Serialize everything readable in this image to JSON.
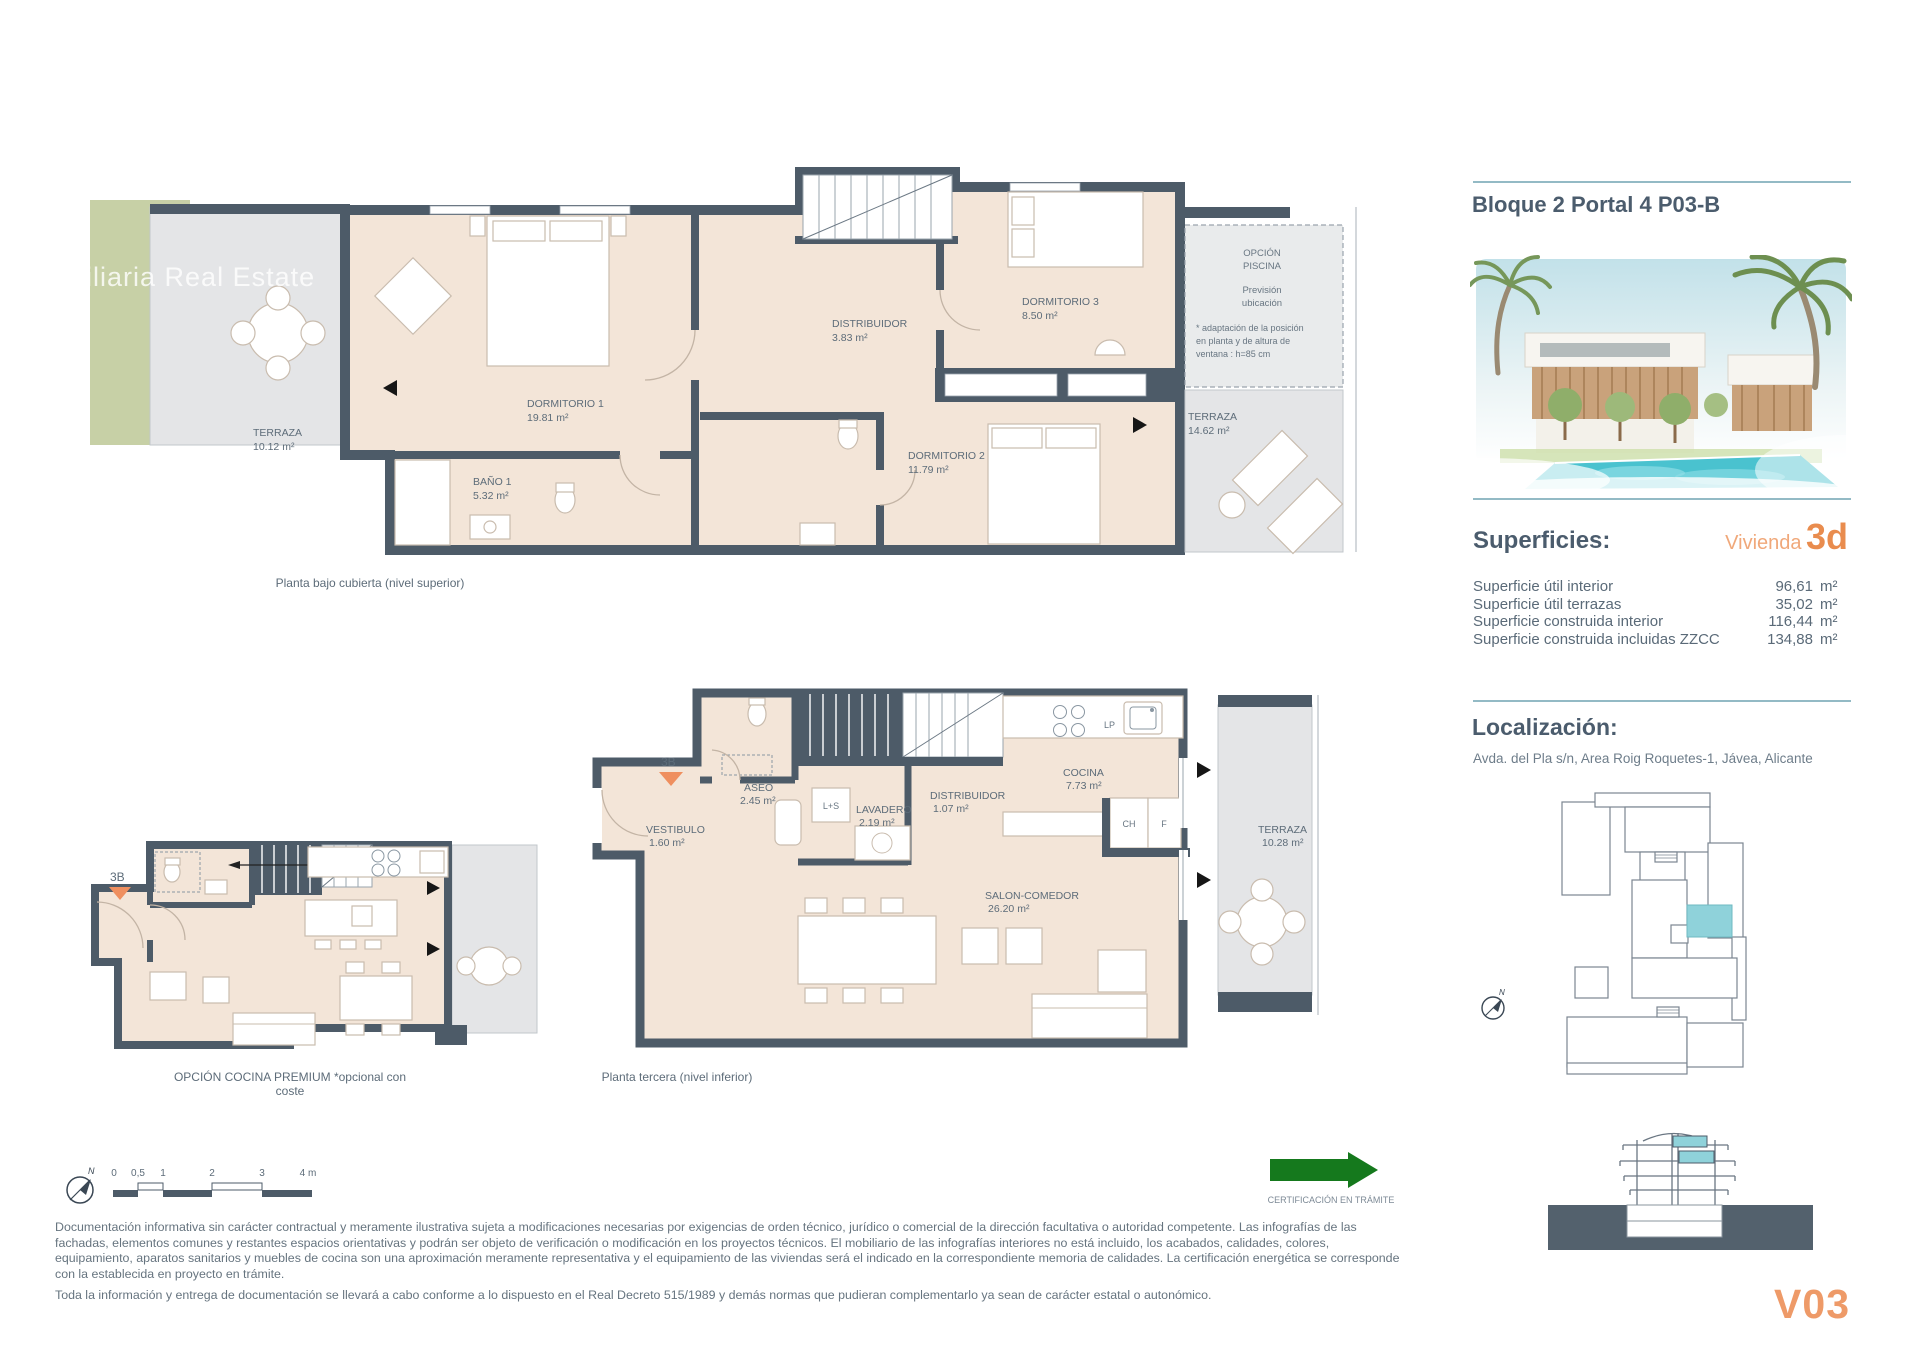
{
  "watermark": "biliaria Real Estate",
  "panel": {
    "title": "Bloque 2 Portal 4 P03-B",
    "superficies": {
      "heading": "Superficies:",
      "vivienda_label": "Vivienda",
      "vivienda_code": "3d",
      "unit": "m²",
      "rows": [
        {
          "label": "Superficie útil interior",
          "value": "96,61"
        },
        {
          "label": "Superficie útil terrazas",
          "value": "35,02"
        },
        {
          "label": "Superficie construida interior",
          "value": "116,44"
        },
        {
          "label": "Superficie construida incluidas ZZCC",
          "value": "134,88"
        }
      ]
    },
    "localizacion": {
      "heading": "Localización:",
      "address": "Avda. del Pla s/n, Area Roig Roquetes-1, Jávea, Alicante"
    },
    "unit_code": "V03"
  },
  "plans": {
    "upper": {
      "caption": "Planta bajo cubierta (nivel superior)",
      "terraza_left": {
        "name": "TERRAZA",
        "area": "10.12 m²"
      },
      "dormitorio1": {
        "name": "DORMITORIO 1",
        "area": "19.81 m²"
      },
      "bano1": {
        "name": "BAÑO 1",
        "area": "5.32 m²"
      },
      "distribuidor": {
        "name": "DISTRIBUIDOR",
        "area": "3.83 m²"
      },
      "dormitorio3": {
        "name": "DORMITORIO 3",
        "area": "8.50 m²"
      },
      "dormitorio2": {
        "name": "DORMITORIO 2",
        "area": "11.79 m²"
      },
      "terraza_right": {
        "name": "TERRAZA",
        "area": "14.62 m²"
      },
      "opcion_piscina": {
        "line1": "OPCIÓN",
        "line2": "PISCINA",
        "line3": "Previsión",
        "line4": "ubicación",
        "note1": "* adaptación de la posición",
        "note2": "en planta y de altura de",
        "note3": "ventana : h=85 cm"
      }
    },
    "premium": {
      "caption": "OPCIÓN COCINA PREMIUM *opcional con coste",
      "marker": "3B"
    },
    "lower": {
      "caption": "Planta tercera (nivel inferior)",
      "marker": "3B",
      "vestibulo": {
        "name": "VESTIBULO",
        "area": "1.60 m²"
      },
      "aseo": {
        "name": "ASEO",
        "area": "2.45 m²"
      },
      "ls": "L+S",
      "lavadero": {
        "name": "LAVADERO",
        "area": "2.19 m²"
      },
      "distribuidor": {
        "name": "DISTRIBUIDOR",
        "area": "1.07 m²"
      },
      "cocina": {
        "name": "COCINA",
        "area": "7.73 m²"
      },
      "lp": "LP",
      "ch": "CH",
      "f": "F",
      "salon": {
        "name": "SALON-COMEDOR",
        "area": "26.20 m²"
      },
      "terraza": {
        "name": "TERRAZA",
        "area": "10.28 m²"
      }
    }
  },
  "scalebar": {
    "north": "N",
    "t0": "0",
    "t05": "0,5",
    "t1": "1",
    "t2": "2",
    "t3": "3",
    "t4": "4 m"
  },
  "certification": "CERTIFICACIÓN EN TRÁMITE",
  "disclaimer": {
    "p1": "Documentación informativa sin carácter contractual y meramente ilustrativa sujeta a modificaciones necesarias por exigencias de orden técnico, jurídico o comercial de la dirección facultativa o autoridad competente. Las infografías de las fachadas, elementos comunes y restantes espacios orientativas y podrán ser objeto de verificación o modificación en los proyectos técnicos. El mobiliario de las infografías interiores no está incluido, los acabados, calidades, colores, equipamiento, aparatos sanitarios y muebles de cocina son una aproximación meramente representativa y el equipamiento de las viviendas será el indicado en la correspondiente memoria de calidades. La certificación energética se corresponde con la establecida en proyecto en trámite.",
    "p2": "Toda la información y entrega de documentación se llevará a cabo conforme a lo dispuesto en el Real Decreto 515/1989 y demás normas que pudieran complementarlo ya sean de carácter estatal o autonómico."
  },
  "colors": {
    "accent_orange": "#ec9a62",
    "wall": "#4d5b68",
    "room_fill": "#f3e5d8",
    "terrace_fill": "#e4e5e7",
    "highlight_cyan": "#8fd2da",
    "rule_teal": "#93bac5",
    "cert_green": "#15791d",
    "garden_green": "#c7d0a6"
  }
}
